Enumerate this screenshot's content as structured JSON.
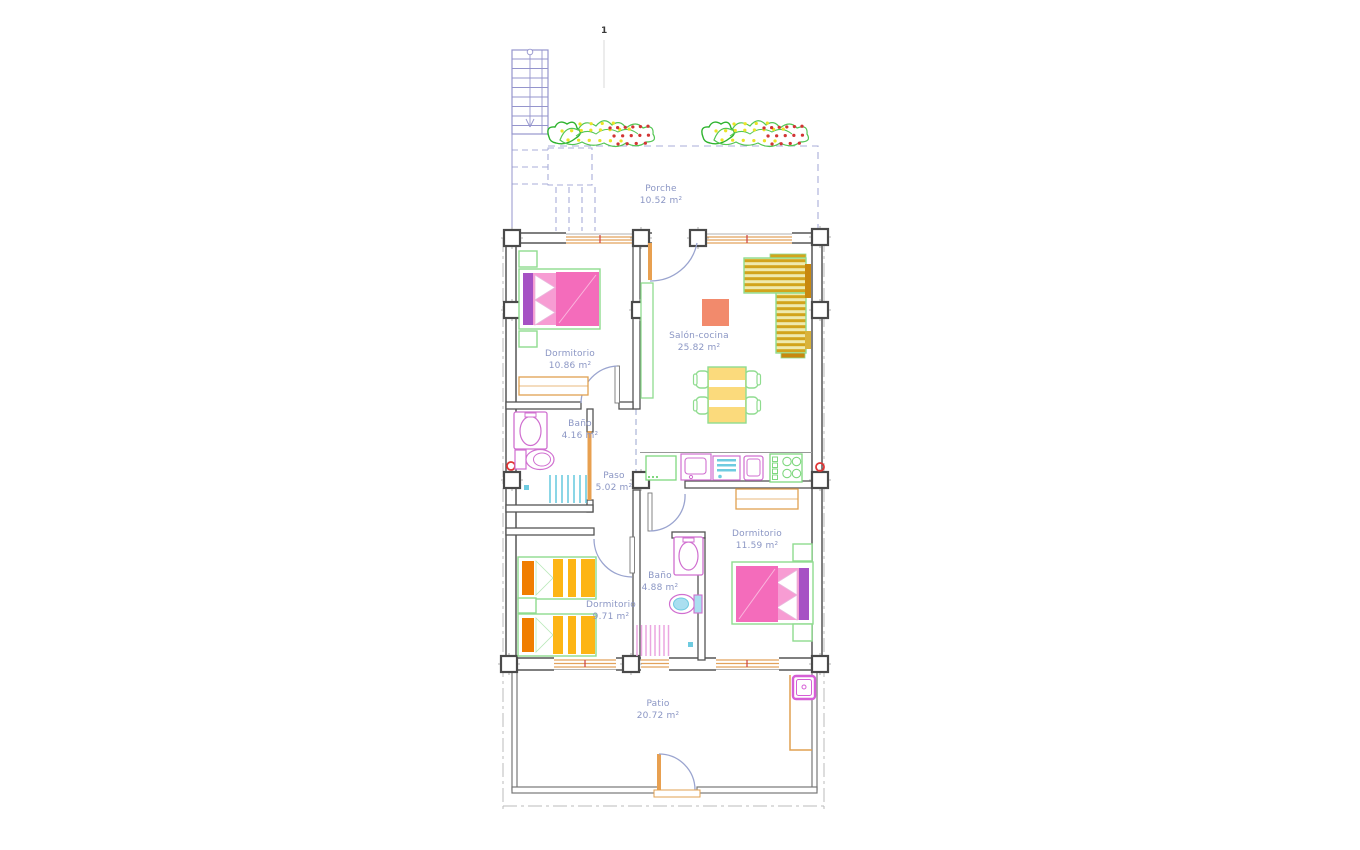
{
  "annotations": {
    "section_marker": "1"
  },
  "rooms": {
    "porche": {
      "name": "Porche",
      "area": "10.52 m²"
    },
    "dorm1": {
      "name": "Dormitorio",
      "area": "10.86 m²"
    },
    "salon": {
      "name": "Salón-cocina",
      "area": "25.82 m²"
    },
    "bano1": {
      "name": "Baño",
      "area": "4.16 m²"
    },
    "paso": {
      "name": "Paso",
      "area": "5.02 m²"
    },
    "dorm2": {
      "name": "Dormitorio",
      "area": "11.59 m²"
    },
    "bano2": {
      "name": "Baño",
      "area": "4.88 m²"
    },
    "dorm3": {
      "name": "Dormitorio",
      "area": "9.71 m²"
    },
    "patio": {
      "name": "Patio",
      "area": "20.72 m²"
    }
  },
  "colors": {
    "wall": "#555555",
    "window_frame": "#e2a25c",
    "door_leaf": "#e8a050",
    "door_arc": "#9aa4cf",
    "label_text": "#8b96c4",
    "bed_pink": "#f46cbb",
    "headboard_purple": "#a651c4",
    "furniture_green": "#8fdc8f",
    "sofa_gold": "#d2a41c",
    "table_yellow": "#fbda7c",
    "bed_orange": "#f07d00",
    "bed_amber": "#fdb515",
    "rug_salmon": "#f28a6c",
    "fixture_magenta": "#d06fd0",
    "fixture_cyan": "#6ecbe0",
    "plant_green": "#53c653",
    "berry_red": "#d23434",
    "flower_yellow": "#ece427",
    "stair_blue": "#9595cd",
    "marker_red": "#e03535"
  }
}
